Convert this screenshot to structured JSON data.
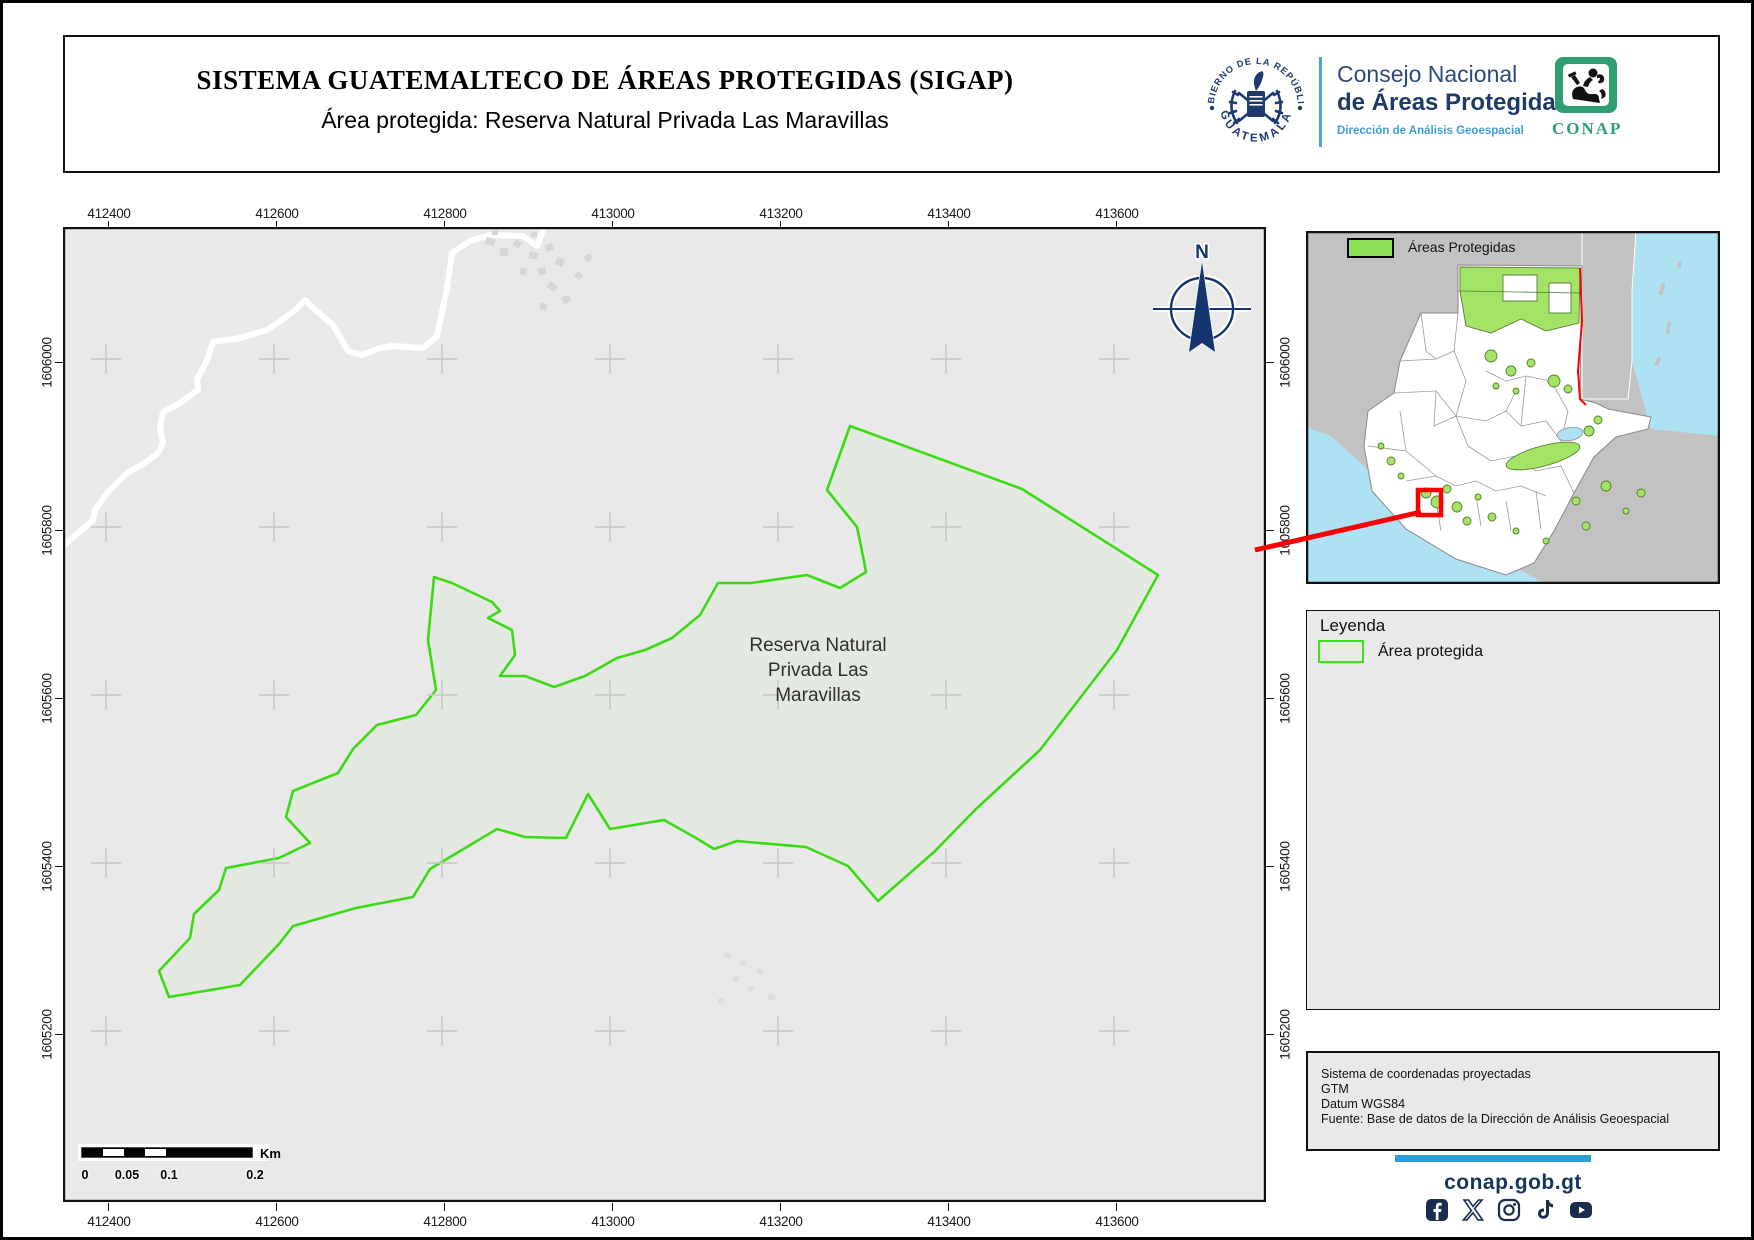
{
  "header": {
    "title": "SISTEMA GUATEMALTECO DE ÁREAS PROTEGIDAS  (SIGAP)",
    "subtitle": "Área protegida: Reserva Natural Privada Las Maravillas",
    "seal": {
      "arc_top": "GOBIERNO DE LA REPÚBLICA",
      "arc_bottom": "GUATEMALA"
    },
    "org": {
      "line1": "Consejo Nacional",
      "line2": "de Áreas Protegidas",
      "line3": "Dirección de Análisis Geoespacial"
    },
    "conap_logo_label": "CONAP"
  },
  "map": {
    "x_ticks": [
      "412400",
      "412600",
      "412800",
      "413000",
      "413200",
      "413400",
      "413600"
    ],
    "y_ticks": [
      "1606000",
      "1605800",
      "1605600",
      "1605400",
      "1605200"
    ],
    "north_label": "N",
    "area_label_lines": [
      "Reserva Natural",
      "Privada Las",
      "Maravillas"
    ],
    "scalebar": {
      "labels": [
        "0",
        "0.05",
        "0.1",
        "0.2"
      ],
      "unit": "Km"
    }
  },
  "inset": {
    "legend_label": "Áreas Protegidas"
  },
  "legend": {
    "title": "Leyenda",
    "item_label": "Área protegida"
  },
  "info_box": {
    "lines": "Sistema de coordenadas proyectadas\nGTM\nDatum WGS84\nFuente: Base de datos de la Dirección de Análisis Geoespacial"
  },
  "footer": {
    "site": "conap.gob.gt",
    "icons": [
      "facebook-icon",
      "x-icon",
      "instagram-icon",
      "tiktok-icon",
      "youtube-icon"
    ]
  },
  "colors": {
    "reserve_stroke": "#3bdb14",
    "reserve_fill": "#e4e9e1",
    "map_bg": "#e9e9e9",
    "inset_land": "#c2c2c2",
    "inset_water": "#aee1f2",
    "inset_protected_green": "#a3e467",
    "marker_red": "#fb0000",
    "navy": "#1e3a6e",
    "light_blue": "#2d9fd8",
    "conap_green": "#2f9e72"
  }
}
